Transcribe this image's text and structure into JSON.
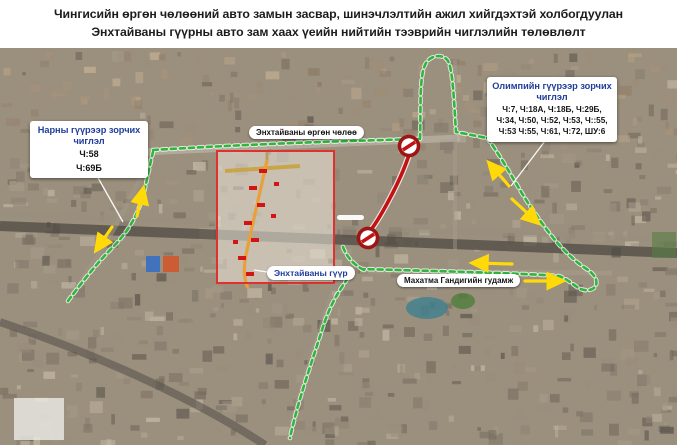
{
  "title": {
    "line1": "Чингисийн өргөн чөлөөний авто замын засвар, шинэчлэлтийн ажил хийгдэхтэй холбогдуулан",
    "line2": "Энхтайваны гүүрны авто зам хаах үеийн нийтийн тээврийн чиглэлийн төлөвлөлт"
  },
  "callouts": {
    "naran": {
      "title": "Нарны гүүрээр зорчих чиглэл",
      "routes": [
        "Ч:58",
        "Ч:69Б"
      ]
    },
    "olympic": {
      "title": "Олимпийн гүүрээр зорчих чиглэл",
      "routes": [
        "Ч:7, Ч:18А, Ч:18Б, Ч:29Б,",
        "Ч:34, Ч:50, Ч:52, Ч:53, Ч::55,",
        "Ч:53 Ч:55, Ч:61, Ч:72, ШУ:6"
      ]
    }
  },
  "map_labels": {
    "boulevard": "Энхтайваны өргөн чөлөө",
    "bridge": "Энхтайваны гүүр",
    "street": "Махатма Гандигийн гудамж"
  },
  "icons": {
    "road_closed": "no-entry-sign",
    "direction": "yellow-arrow"
  },
  "colors": {
    "route_open": "#2db83c",
    "route_closed": "#c41111",
    "closed_sign_ring": "#9e1515",
    "arrow": "#ffd908",
    "callout_title": "#1f3d99",
    "inset_border": "#e03131",
    "bridge_road": "#e8a13a"
  }
}
